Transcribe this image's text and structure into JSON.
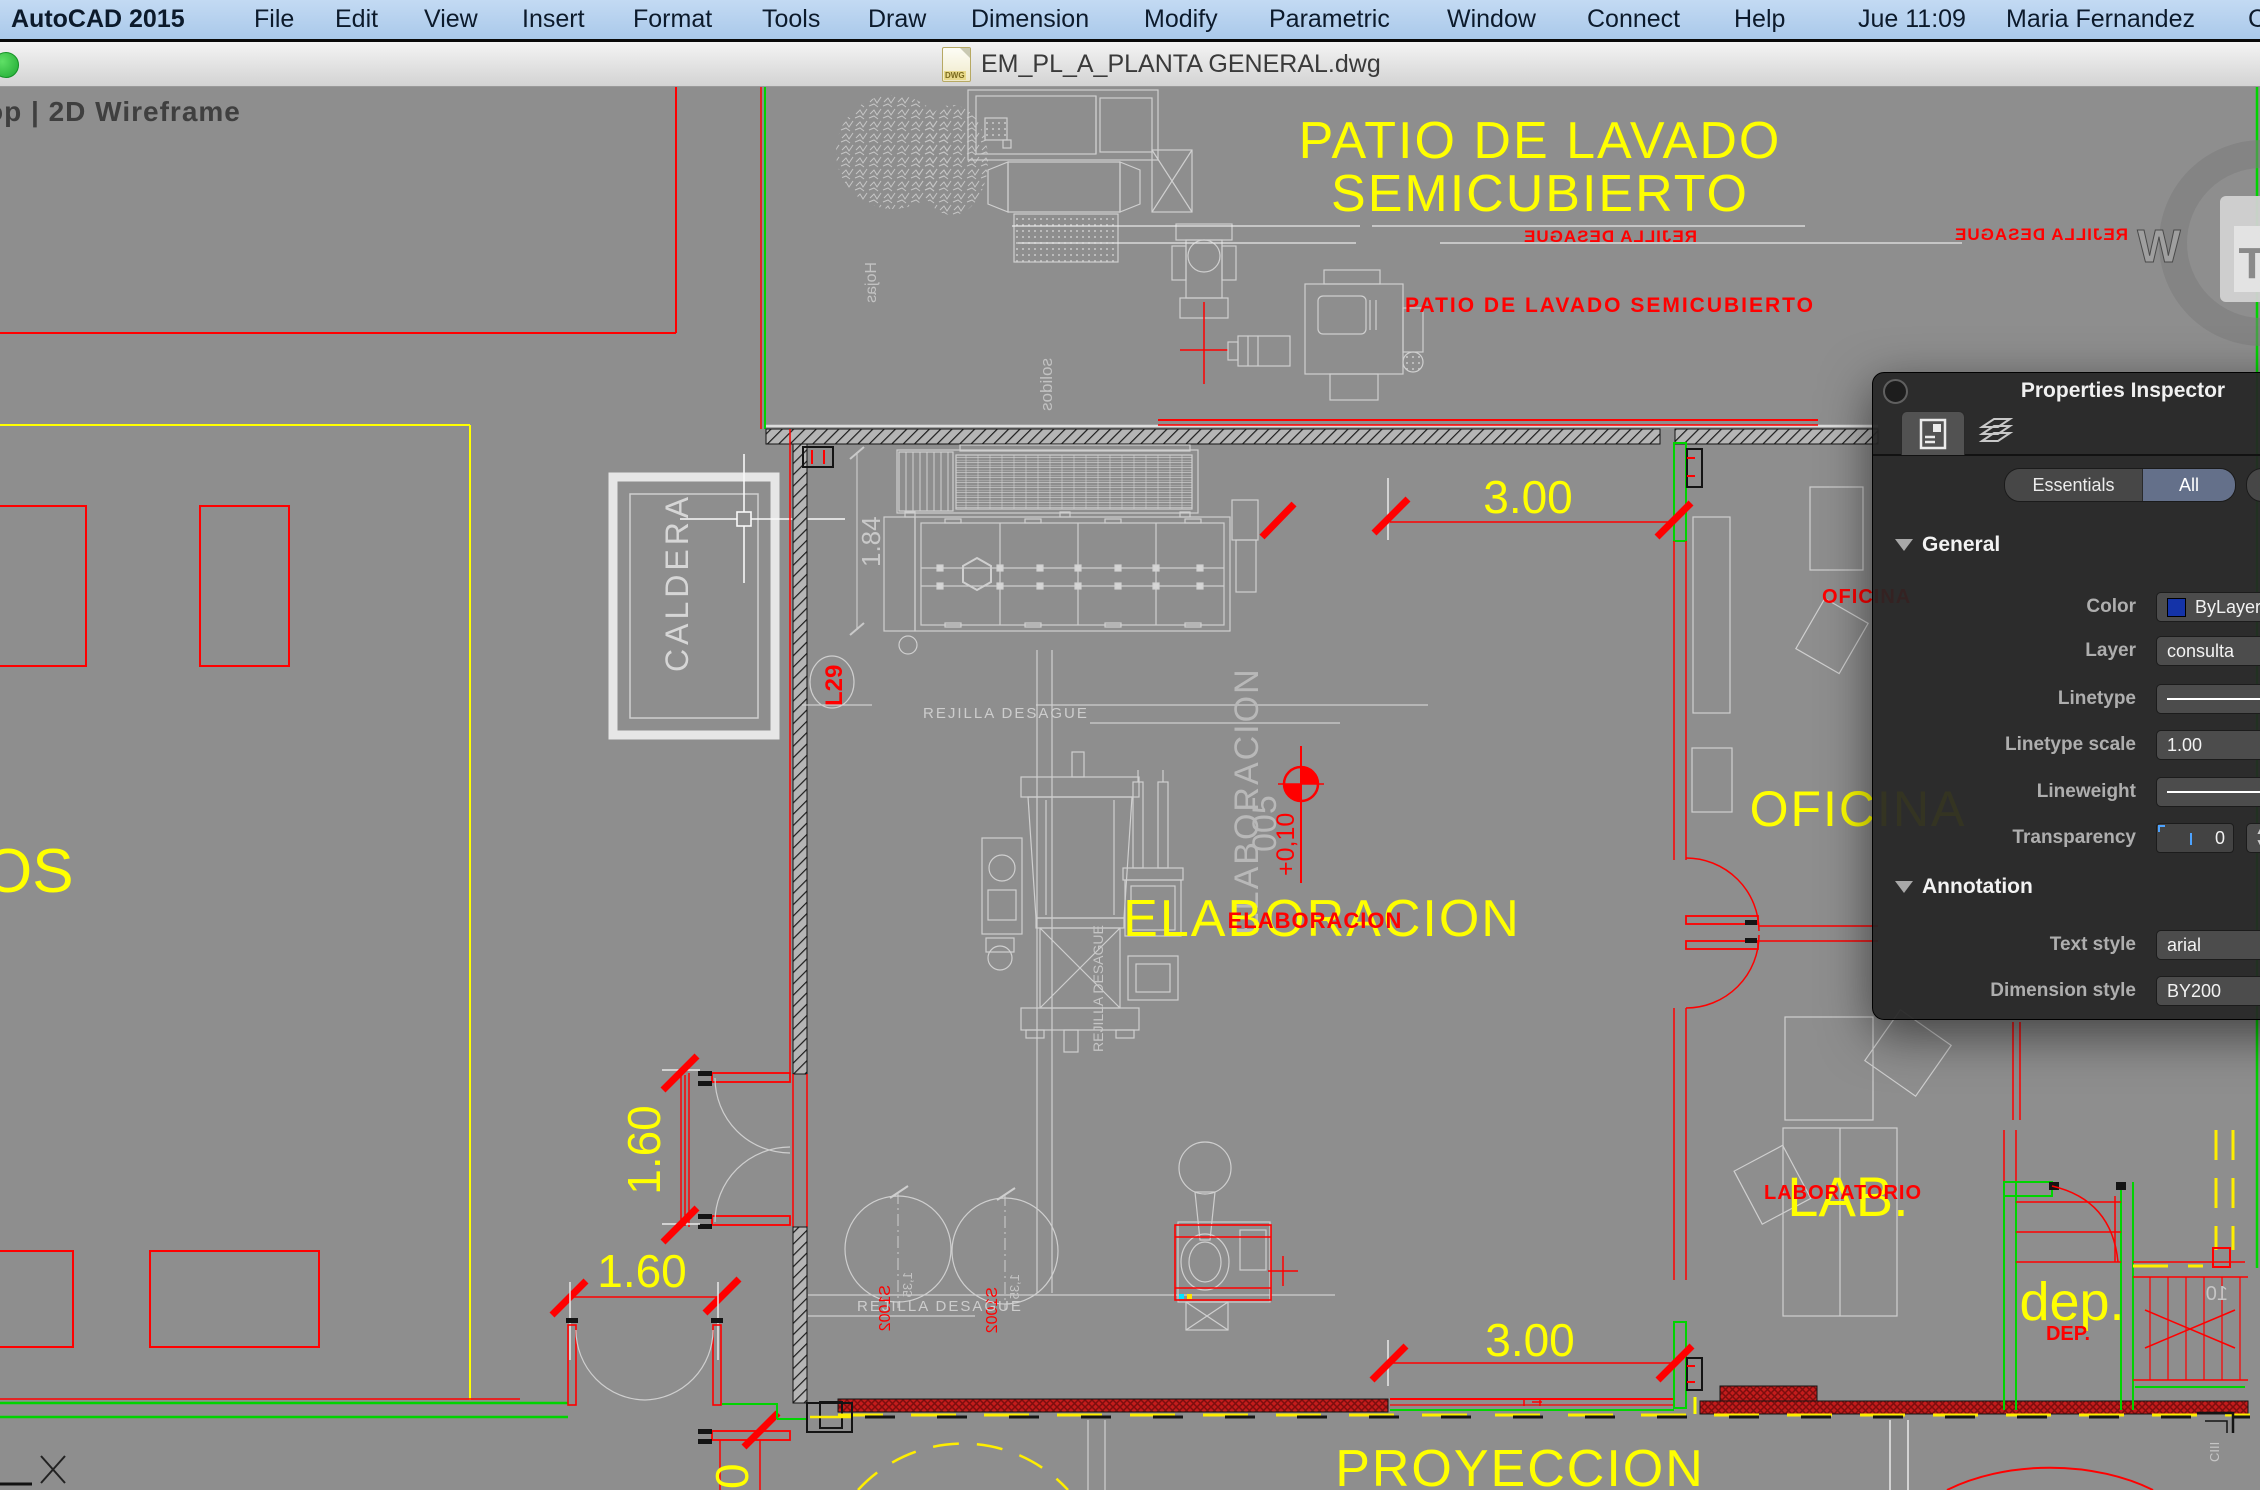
{
  "menu_bar": {
    "app_name": "AutoCAD 2015",
    "items": [
      "File",
      "Edit",
      "View",
      "Insert",
      "Format",
      "Tools",
      "Draw",
      "Dimension",
      "Modify",
      "Parametric",
      "Window",
      "Connect",
      "Help"
    ],
    "clock": "Jue 11:09",
    "user": "Maria Fernandez"
  },
  "title_bar": {
    "filename": "EM_PL_A_PLANTA GENERAL.dwg"
  },
  "viewport": {
    "corner_label": "op | 2D Wireframe",
    "viewcube_west": "W",
    "viewcube_top": "T"
  },
  "panel": {
    "title": "Properties Inspector",
    "seg_essentials": "Essentials",
    "seg_all": "All",
    "general": {
      "header": "General",
      "color_label": "Color",
      "color_value": "ByLayer",
      "layer_label": "Layer",
      "layer_value": "consulta",
      "linetype_label": "Linetype",
      "lscale_label": "Linetype scale",
      "lscale_value": "1.00",
      "lweight_label": "Lineweight",
      "transp_label": "Transparency",
      "transp_value": "0"
    },
    "annotation": {
      "header": "Annotation",
      "tstyle_label": "Text style",
      "tstyle_value": "arial",
      "dstyle_label": "Dimension style",
      "dstyle_value": "BY200"
    }
  },
  "drawing": {
    "labels": {
      "patio1": "PATIO DE LAVADO",
      "patio2": "SEMICUBIERTO",
      "patio_red": "PATIO DE LAVADO SEMICUBIERTO",
      "rejilla": "REJILLA DESAGUE",
      "elab_big": "ELABORACION",
      "elab_red": "ELABORACION",
      "elab_vert": "ELABORACION",
      "elab_num": "005",
      "level_mark": "+0,10",
      "oficina": "OFICINA",
      "oficina_red": "OFICINA",
      "lab": "LAB.",
      "lab_red": "LABORATORIO",
      "dep": "dep.",
      "dep_red": "DEP.",
      "proyeccion": "PROYECCION",
      "os": "OS",
      "caldera": "CALDERA",
      "l29": "L29",
      "hojas": "Hojas",
      "solidos": "solidos",
      "ciii": "CIII",
      "stair_num": "10",
      "tank_red": "S1002",
      "tank_gray": "1,35"
    },
    "dims": {
      "d184": "1.84",
      "d300_top": "3.00",
      "d300_bottom": "3.00",
      "d160_v": "1.60",
      "d160_h": "1.60",
      "d0": "0"
    },
    "colors": {
      "canvas": "#8e8e8e",
      "cad_yellow": "#ffff00",
      "cad_red": "#ff0000",
      "cad_green": "#00d400",
      "accent_blue": "#1433a8"
    }
  }
}
